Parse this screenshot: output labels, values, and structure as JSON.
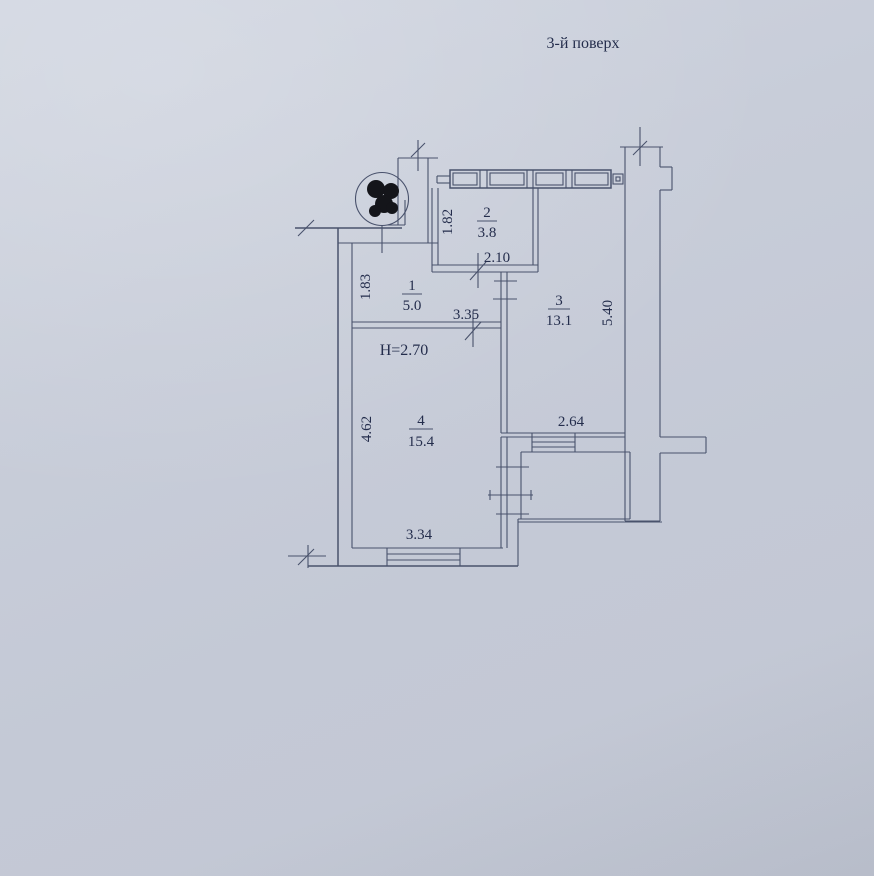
{
  "title": "3-й поверх",
  "colors": {
    "paper": "#c8cdd9",
    "ink": "#49526c",
    "text": "#242d4c"
  },
  "rooms": [
    {
      "number": "1",
      "area": "5.0"
    },
    {
      "number": "2",
      "area": "3.8"
    },
    {
      "number": "3",
      "area": "13.1"
    },
    {
      "number": "4",
      "area": "15.4"
    }
  ],
  "dimensions": {
    "room1_depth": "1.83",
    "room2_depth": "1.82",
    "room2_width": "2.10",
    "room1_width": "3.35",
    "ceiling_height": "H=2.70",
    "room3_depth": "5.40",
    "room3_width": "2.64",
    "room4_depth": "4.62",
    "room4_width": "3.34"
  }
}
